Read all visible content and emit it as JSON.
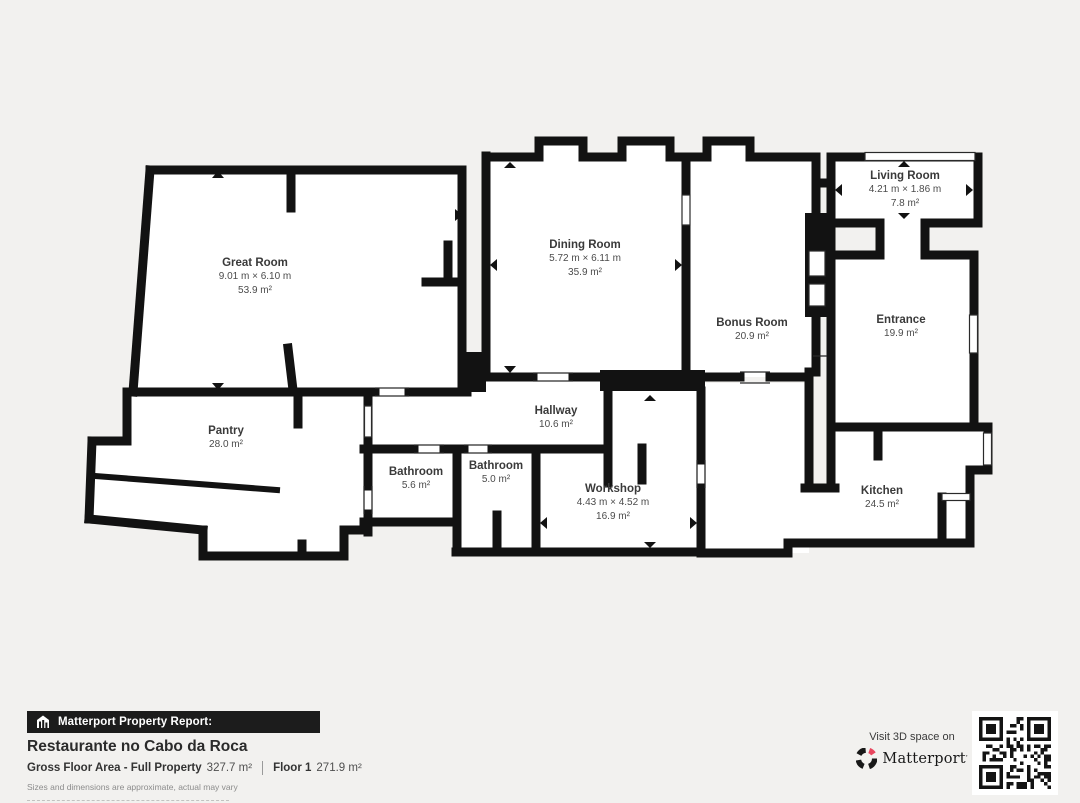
{
  "plan": {
    "wall_color": "#121212",
    "rooms": [
      {
        "name": "Great Room",
        "dims": "9.01 m × 6.10 m",
        "area": "53.9 m²"
      },
      {
        "name": "Dining Room",
        "dims": "5.72 m × 6.11 m",
        "area": "35.9 m²"
      },
      {
        "name": "Living Room",
        "dims": "4.21 m × 1.86 m",
        "area": "7.8 m²"
      },
      {
        "name": "Bonus Room",
        "area": "20.9 m²"
      },
      {
        "name": "Entrance",
        "area": "19.9 m²"
      },
      {
        "name": "Pantry",
        "area": "28.0 m²"
      },
      {
        "name": "Hallway",
        "area": "10.6 m²"
      },
      {
        "name": "Bathroom",
        "area": "5.6 m²"
      },
      {
        "name": "Bathroom",
        "area": "5.0 m²"
      },
      {
        "name": "Workshop",
        "dims": "4.43 m × 4.52 m",
        "area": "16.9 m²"
      },
      {
        "name": "Kitchen",
        "area": "24.5 m²"
      }
    ]
  },
  "footer": {
    "report_label": "Matterport Property Report:",
    "property_name": "Restaurante no Cabo da Roca",
    "gross_label": "Gross Floor Area - Full Property",
    "gross_value": "327.7 m²",
    "floor_label": "Floor 1",
    "floor_value": "271.9 m²",
    "disclaimer": "Sizes and dimensions are approximate, actual may vary",
    "visit_text": "Visit 3D space on",
    "brand": "Matterport",
    "brand_mark": "’",
    "brand_color": "#e8465e"
  }
}
